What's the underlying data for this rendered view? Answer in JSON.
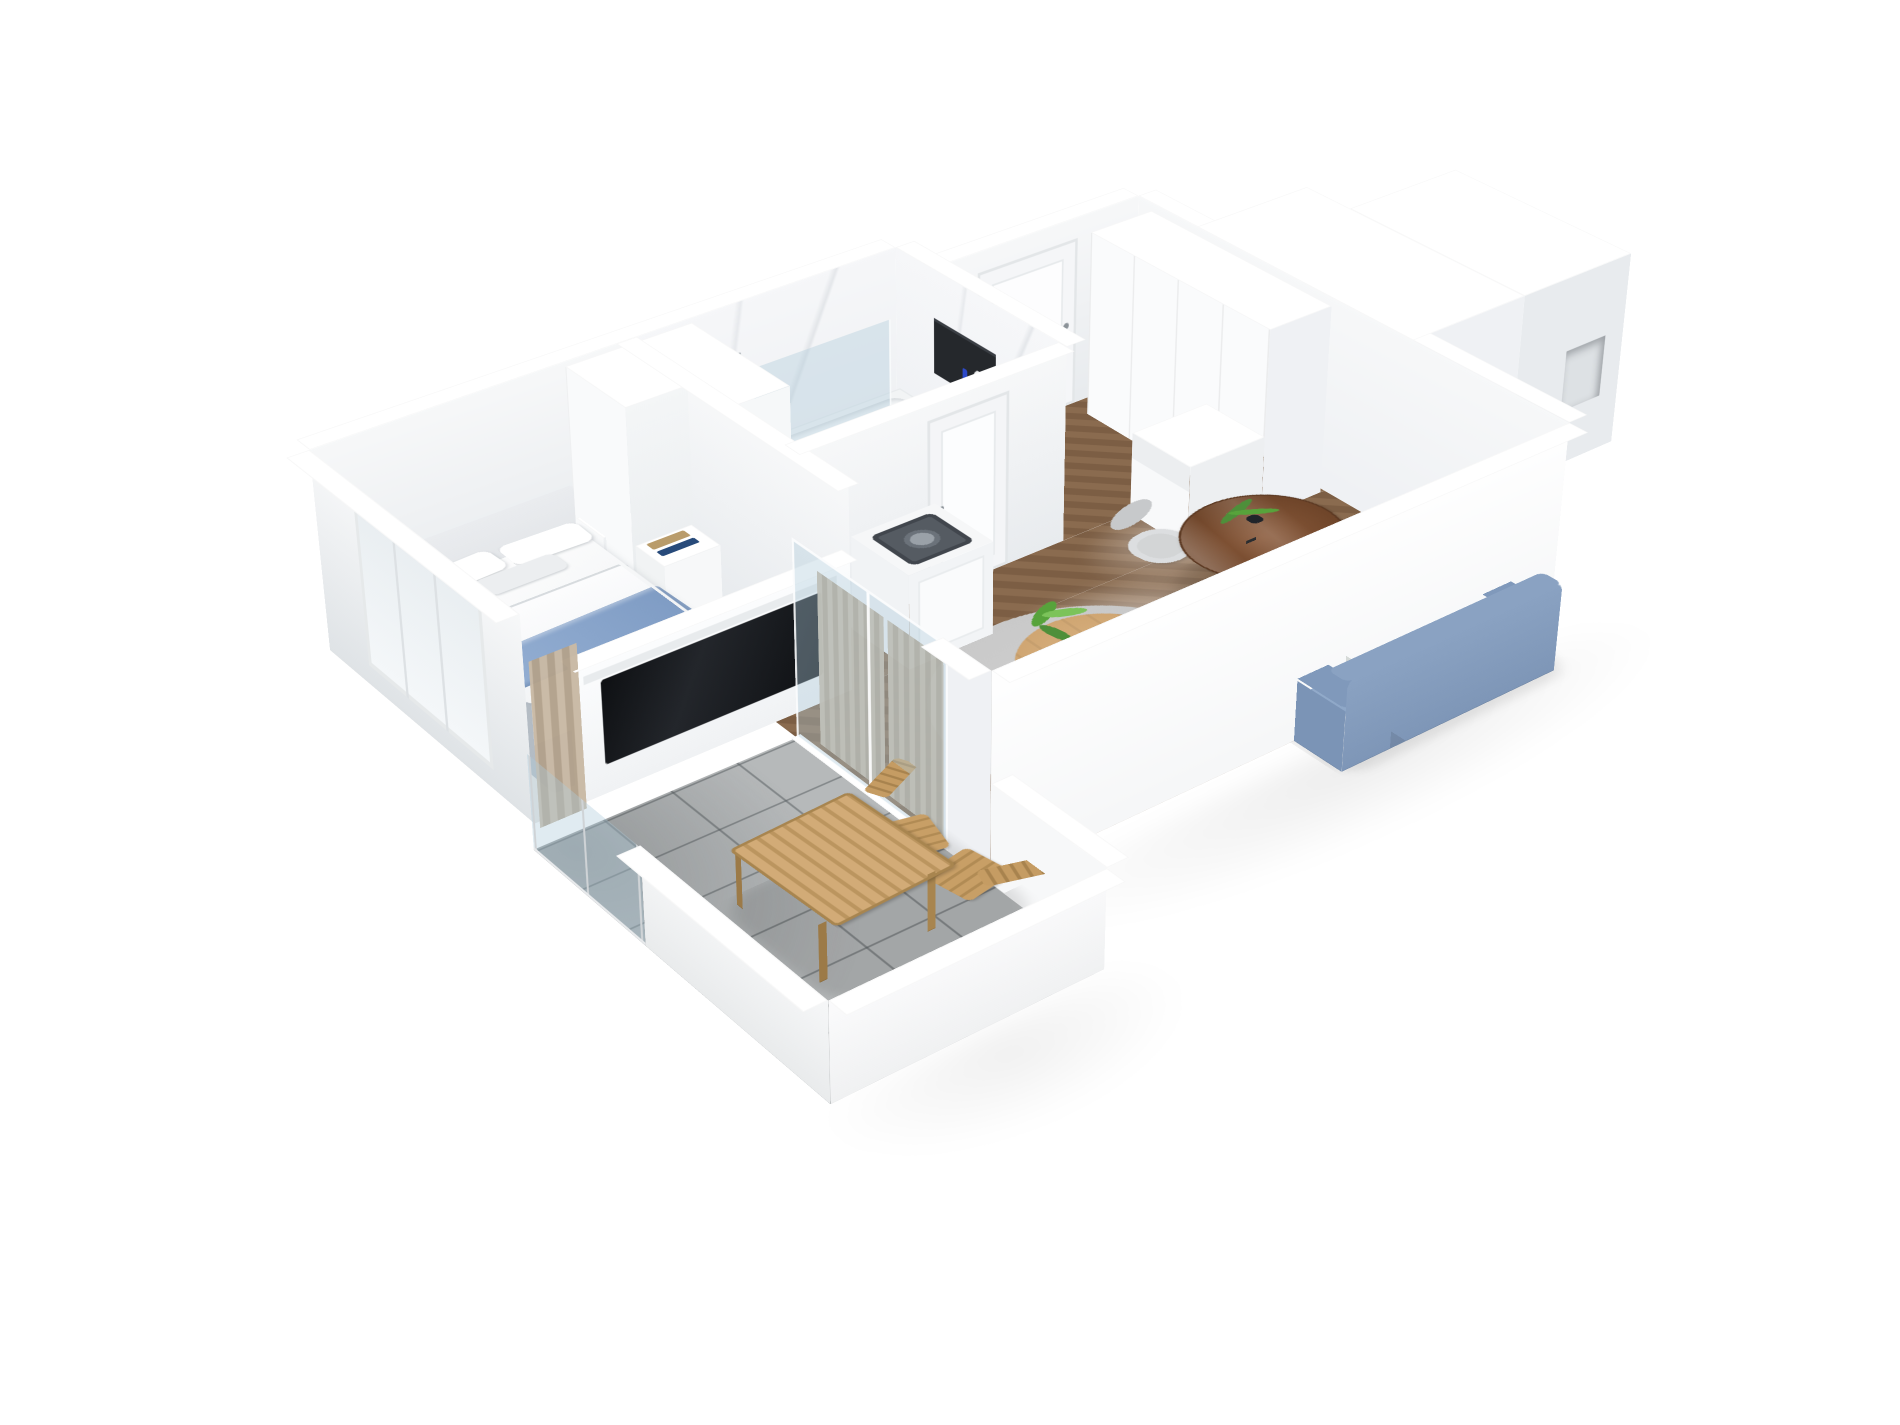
{
  "scene": {
    "kind": "3d-isometric-floorplan-render",
    "background": "#ffffff",
    "rooms": [
      {
        "name": "bedroom",
        "floor": "light-gray"
      },
      {
        "name": "bathroom",
        "floor": "white-tile"
      },
      {
        "name": "entry-hallway",
        "floor": "herringbone-parquet"
      },
      {
        "name": "living-room",
        "floor": "herringbone-parquet"
      },
      {
        "name": "balcony",
        "floor": "gray-ceramic-tile"
      }
    ]
  },
  "palette": {
    "wallLight": "#f7f8f9",
    "wallMid": "#eff1f4",
    "wallShade": "#e8ebee",
    "wallDeep": "#dfe3e6",
    "capWhite": "#ffffff",
    "marble": "#f6f7f9",
    "parquetA": "#8a6b4f",
    "parquetB": "#7c5e44",
    "parquetLine": "rgba(58,40,26,0.28)",
    "bedroomFloor": "#e4e3e0",
    "bathFloor": "#f2f3f5",
    "tileGray": "#b6b9ba",
    "grout": "rgba(90,96,99,0.55)",
    "rugBedroom": "#a9b2ba",
    "rugLiving": "#c9c9c9",
    "sofa": "#8ea7c7",
    "sofaDark": "#7e96b7",
    "sofaArm": "#8099bb",
    "cushionGray": "#d6dad8",
    "cushionBlue": "#9cb4d3",
    "throwA": "#93aed2",
    "throwB": "#7f9cc4",
    "woodTop": "#cfa571",
    "woodDining": "#8a5a3b",
    "woodDiningDark": "#6b4227",
    "chairGray": "#d3d5d6",
    "chairGrayDark": "#c7c9cb",
    "plantGreen": "#57a33b",
    "plantLight": "#7cc35a",
    "potBlue": "#8fa6d6",
    "vaseBlue": "#2c3fb0",
    "nicheDark": "#25282c",
    "tvBlack": "#0e1013",
    "glass": "rgba(173,203,218,0.38)",
    "chrome": "#98a1a7",
    "curtainA": "#c9b9a4",
    "curtainB": "#b2a18b",
    "teak": "#c89f66",
    "teakDark": "#a8854f",
    "appliance": "#555b62"
  },
  "furniture": {
    "bedroom": [
      "double-bed",
      "headboard",
      "pillows",
      "blue-throw-blanket",
      "nightstand-left",
      "nightstand-right",
      "potted-plant",
      "area-rug",
      "wardrobe",
      "book-shelf",
      "tv-partition",
      "tv"
    ],
    "bathroom": [
      "bathtub",
      "glass-shower-screen",
      "shower-fixture",
      "toilet",
      "sink-vanity",
      "round-basin",
      "tall-cabinet",
      "black-wall-niche",
      "blue-vase",
      "bathroom-door"
    ],
    "hallway": [
      "entry-door",
      "wardrobe-cabinets",
      "bench-unit"
    ],
    "living_room": [
      "blue-sofa",
      "cushions",
      "round-gray-rug",
      "round-coffee-table",
      "potted-plant",
      "notebook",
      "round-dining-table",
      "dining-chair",
      "dining-chair",
      "washing-machine-cabinet",
      "curtains",
      "glass-balcony-door"
    ],
    "balcony": [
      "glass-railing",
      "parapet-walls",
      "wooden-slat-table",
      "folding-chair",
      "folding-chair"
    ]
  }
}
